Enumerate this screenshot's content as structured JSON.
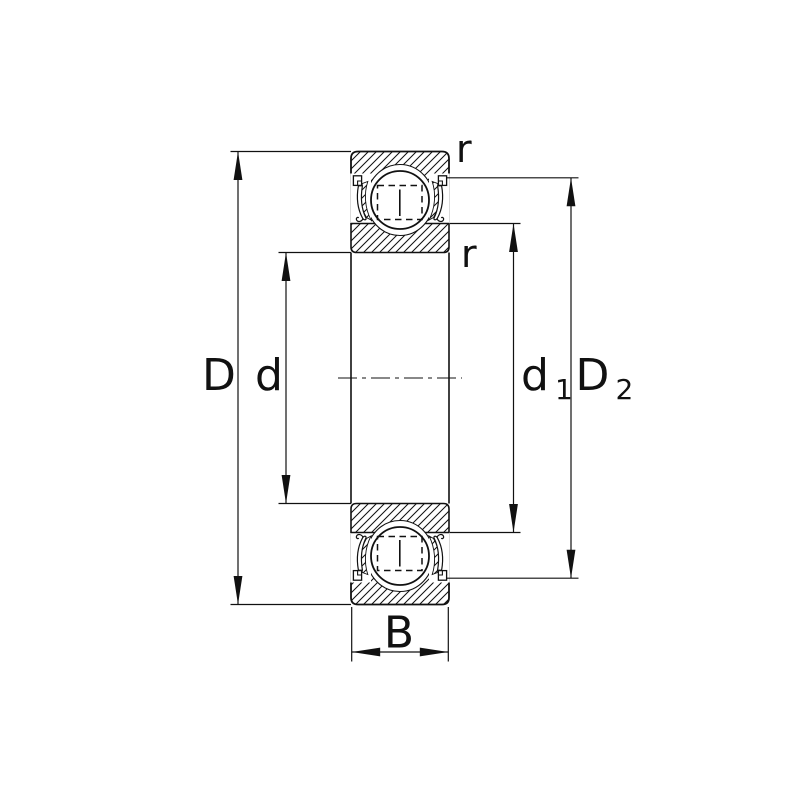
{
  "diagram": {
    "labels": {
      "outer_diameter": "D",
      "bore_diameter": "d",
      "inner_shoulder_base": "d",
      "inner_shoulder_sub": "1",
      "recess_base": "D",
      "recess_sub": "2",
      "width": "B",
      "chamfer_outer": "r",
      "chamfer_inner": "r"
    },
    "colors": {
      "line": "#111111",
      "background": "#ffffff"
    }
  }
}
